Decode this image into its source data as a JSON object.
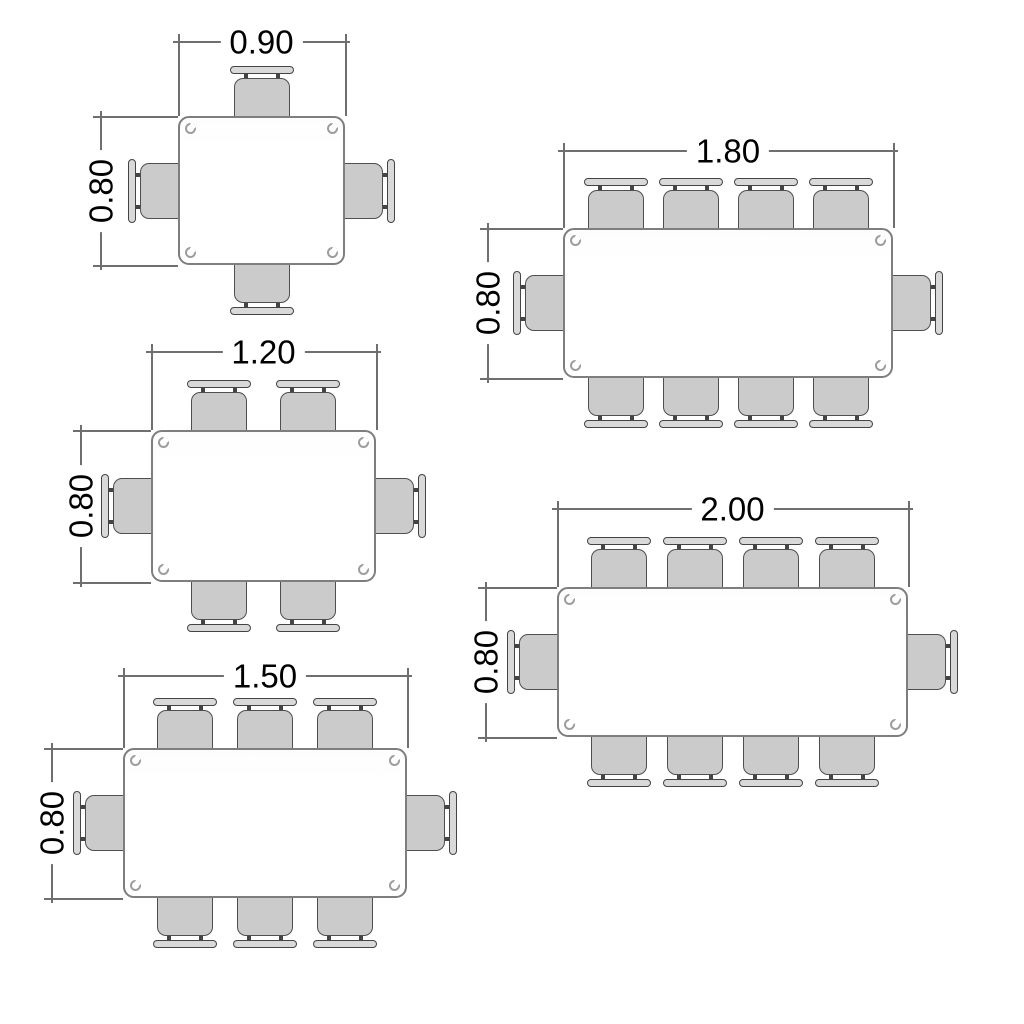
{
  "colors": {
    "background": "#ffffff",
    "dimension_line": "#6f6f6f",
    "dimension_text": "#000000",
    "table_fill": "#ffffff",
    "table_border": "#7e7e7e",
    "screw_color": "#9c9c9c",
    "seat_fill": "#cbcbcb",
    "seat_border": "#4f4f4f",
    "backrest_fill": "#d9d9d9",
    "backrest_border": "#444444"
  },
  "diagram": {
    "type": "furniture-seating-plan",
    "view": "top",
    "tables": [
      {
        "width_label": "0.90",
        "depth_label": "0.80",
        "seats": 4,
        "chairs": {
          "top": 1,
          "bottom": 1,
          "left": 1,
          "right": 1
        },
        "geom": {
          "x": 178,
          "y": 116,
          "w": 167,
          "h": 149,
          "dimY": 41,
          "dimX": 100,
          "pitch": 0
        }
      },
      {
        "width_label": "1.20",
        "depth_label": "0.80",
        "seats": 6,
        "chairs": {
          "top": 2,
          "bottom": 2,
          "left": 1,
          "right": 1
        },
        "geom": {
          "x": 151,
          "y": 430,
          "w": 225,
          "h": 152,
          "dimY": 351,
          "dimX": 80,
          "pitch": 89
        }
      },
      {
        "width_label": "1.50",
        "depth_label": "0.80",
        "seats": 8,
        "chairs": {
          "top": 3,
          "bottom": 3,
          "left": 1,
          "right": 1
        },
        "geom": {
          "x": 123,
          "y": 748,
          "w": 284,
          "h": 150,
          "dimY": 675,
          "dimX": 51,
          "pitch": 80
        }
      },
      {
        "width_label": "1.80",
        "depth_label": "0.80",
        "seats": 10,
        "chairs": {
          "top": 4,
          "bottom": 4,
          "left": 1,
          "right": 1
        },
        "geom": {
          "x": 563,
          "y": 228,
          "w": 330,
          "h": 150,
          "dimY": 150,
          "dimX": 487,
          "pitch": 75
        }
      },
      {
        "width_label": "2.00",
        "depth_label": "0.80",
        "seats": 10,
        "chairs": {
          "top": 4,
          "bottom": 4,
          "left": 1,
          "right": 1
        },
        "geom": {
          "x": 557,
          "y": 587,
          "w": 351,
          "h": 150,
          "dimY": 508,
          "dimX": 485,
          "pitch": 76
        }
      }
    ]
  }
}
